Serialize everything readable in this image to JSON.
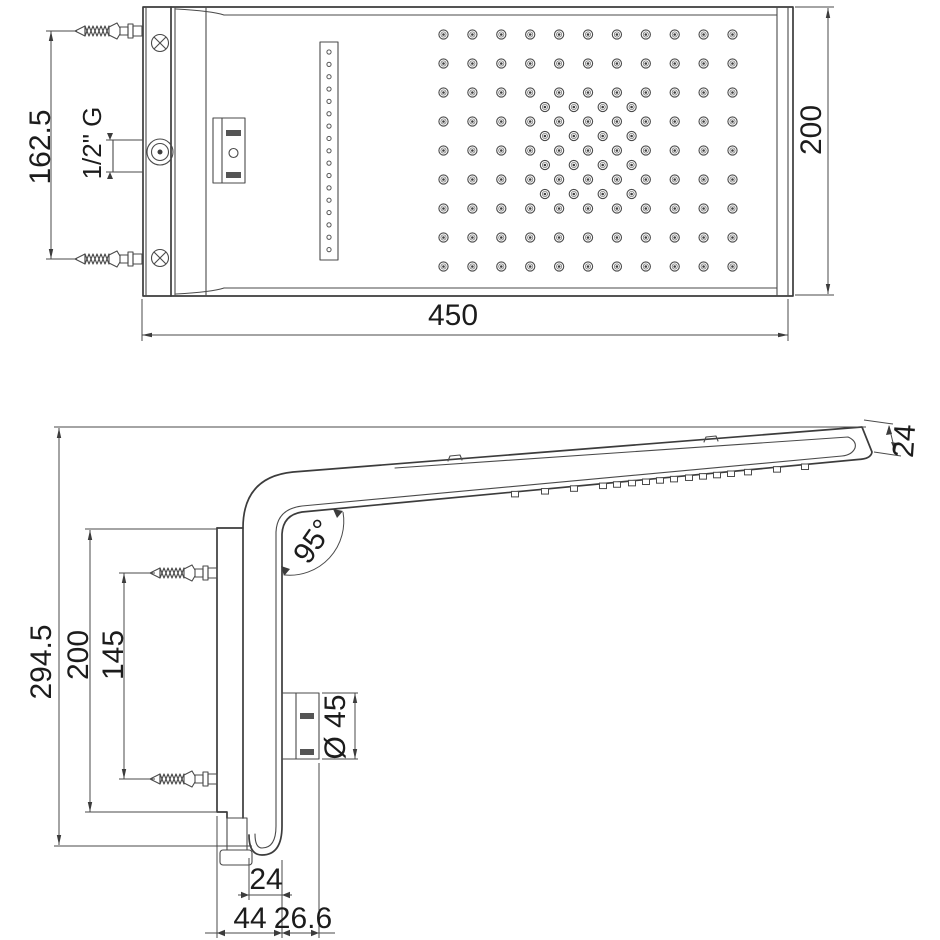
{
  "drawing": {
    "product": "wall-mounted shower head dimensional drawing",
    "background": "#ffffff",
    "line_color": "#3c3c3c",
    "text_color": "#1c1c1c"
  },
  "top_view": {
    "dimensions": {
      "width": "450",
      "height": "200",
      "anchor_spacing": "162.5",
      "thread": "1/2\" G"
    },
    "nozzle_grid": {
      "cols": 11,
      "rows": 9,
      "x0": 443.5,
      "y0": 34.5,
      "dx": 28.9,
      "dy": 29,
      "offset_block": {
        "cols": 4,
        "rows": 4,
        "x0": 544.9,
        "y0": 107,
        "dx": 28.9,
        "dy": 29
      }
    },
    "slot_strip": {
      "holes": 17,
      "x": 329,
      "y0": 52,
      "dy": 12.35,
      "r": 2.1
    }
  },
  "side_view": {
    "dimensions": {
      "total_height": "294.5",
      "plate_height": "200",
      "anchor_spacing": "145",
      "head_angle": "95°",
      "head_thickness": "24",
      "escutcheon_diameter": "Ø 45",
      "spout_width": "24",
      "plate_depth": "44",
      "escutcheon_offset": "26.6"
    },
    "spray_nozzle_x": [
      515,
      545,
      574,
      603,
      617,
      632,
      646,
      660,
      674,
      689,
      703,
      717,
      731,
      748,
      777,
      805
    ],
    "spray_line": {
      "x1": 302,
      "y1": 512,
      "x2": 858,
      "y2": 459.5
    }
  }
}
